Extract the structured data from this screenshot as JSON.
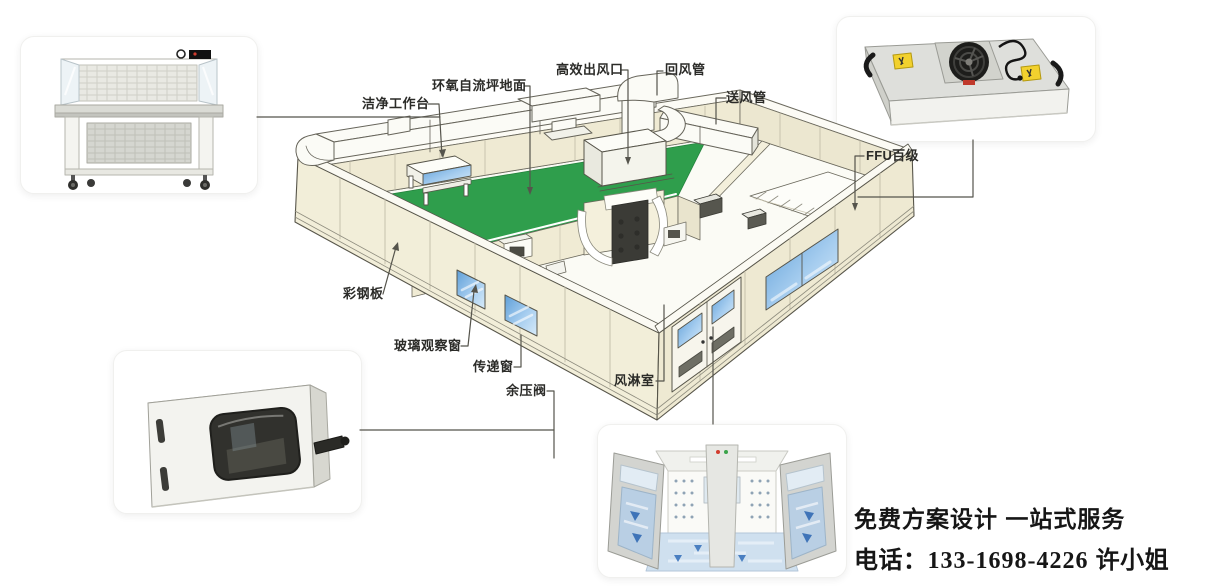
{
  "page": {
    "background": "#ffffff"
  },
  "callouts": {
    "epoxy_floor": "环氧自流坪地面",
    "clean_bench": "洁净工作台",
    "hepa_outlet": "高效出风口",
    "return_duct": "回风管",
    "supply_duct": "送风管",
    "ffu": "FFU百级",
    "steel_panel": "彩钢板",
    "glass_window": "玻璃观察窗",
    "pass_window": "传递窗",
    "pressure_valve": "余压阀",
    "air_shower": "风淋室"
  },
  "contact": {
    "line1": "免费方案设计 一站式服务",
    "phone_label": "电话：",
    "phone_number": "133-1698-4226",
    "contact_person": "许小姐"
  },
  "colors": {
    "wall": "#f1edd8",
    "wall_outline": "#57554a",
    "floor_green": "#2f9e4c",
    "window_blue": "#8fc0ea",
    "duct_white": "#fbfbf6",
    "leader_line": "#55544c",
    "text": "#2b2b28"
  },
  "product_photos": [
    "clean-workbench",
    "ffu-fan-filter-unit",
    "pass-box",
    "air-shower-room"
  ]
}
